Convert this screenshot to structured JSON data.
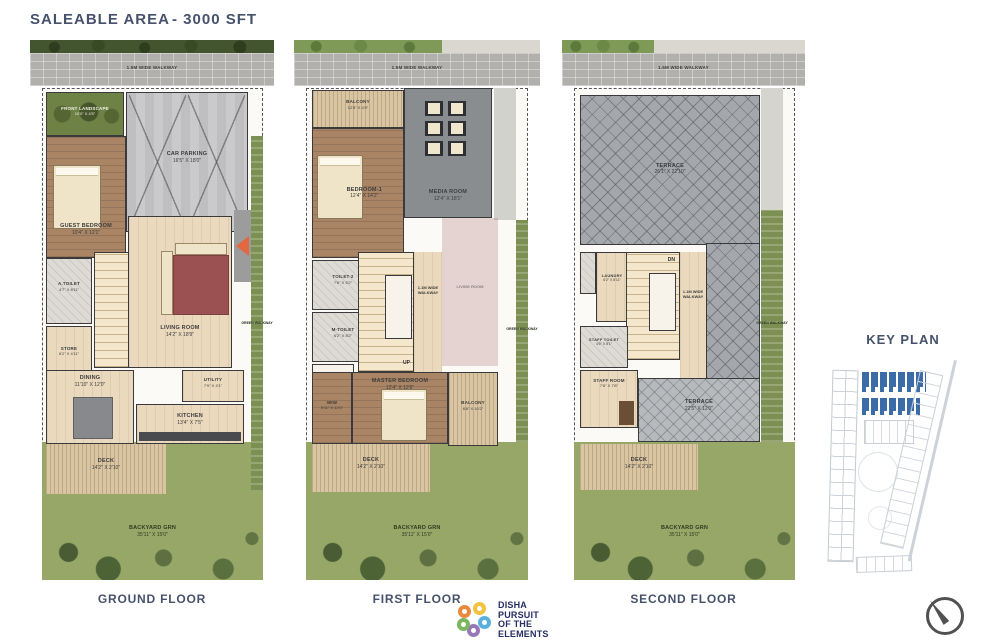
{
  "header": {
    "title": "SALEABLE AREA",
    "area": "- 3000 SFT"
  },
  "floors": [
    {
      "label": "GROUND FLOOR",
      "walkway_label": "1.5M WIDE WALKWAY",
      "rooms": {
        "front_landscape": {
          "name": "FRONT LANDSCAPE",
          "dims": "10'0\" X 4'5\""
        },
        "car_parking": {
          "name": "CAR PARKING",
          "dims": "16'5\" X 18'0\""
        },
        "guest_bedroom": {
          "name": "GUEST BEDROOM",
          "dims": "10'4\" X 12'1\""
        },
        "a_toilet": {
          "name": "A.TOILET",
          "dims": "4'7\" X 8'11\""
        },
        "store": {
          "name": "STORE",
          "dims": "6'2\" X 4'11\""
        },
        "living_room": {
          "name": "LIVING ROOM",
          "dims": "14'2\" X 18'9\""
        },
        "stairs": {
          "name": "UP"
        },
        "green_walkway": {
          "name": "GREEN WALKWAY"
        },
        "dining": {
          "name": "DINING",
          "dims": "11'10\" X 12'0\""
        },
        "utility": {
          "name": "UTILITY",
          "dims": "7'9\" X 4'1\""
        },
        "kitchen": {
          "name": "KITCHEN",
          "dims": "13'4\" X 7'5\""
        },
        "deck": {
          "name": "DECK",
          "dims": "14'2\" X 2'10\""
        },
        "backyard": {
          "name": "BACKYARD GRN",
          "dims": "35'11\" X 15'0\""
        }
      }
    },
    {
      "label": "FIRST FLOOR",
      "walkway_label": "1.5M WIDE WALKWAY",
      "rooms": {
        "balcony_front": {
          "name": "BALCONY",
          "dims": "12'8\" X 4'9\""
        },
        "bedroom_1": {
          "name": "BEDROOM-1",
          "dims": "12'4\" X 14'2\""
        },
        "media_room": {
          "name": "MEDIA ROOM",
          "dims": "12'4\" X 18'1\""
        },
        "toilet_2": {
          "name": "TOILET-2",
          "dims": "7'6\" X 5'2\""
        },
        "m_toilet": {
          "name": "M-TOILET",
          "dims": "6'2\" X 8'2\""
        },
        "walkway_corridor": {
          "name": "1.1M WIDE WALKWAY"
        },
        "stairs": {
          "name": "UP"
        },
        "living_void": {
          "name": "LIVING ROOM"
        },
        "wiw": {
          "name": "WIW",
          "dims": "5'11\" X 12'0\""
        },
        "master_bedroom": {
          "name": "MASTER BEDROOM",
          "dims": "12'4\" X 12'6\""
        },
        "balcony_rear": {
          "name": "BALCONY",
          "dims": "6'8\" X 10'2\""
        },
        "green_walkway": {
          "name": "GREEN WALKWAY"
        },
        "deck": {
          "name": "DECK",
          "dims": "14'2\" X 2'10\""
        },
        "backyard": {
          "name": "BACKYARD GRN",
          "dims": "35'11\" X 15'0\""
        }
      }
    },
    {
      "label": "SECOND FLOOR",
      "walkway_label": "1.5M WIDE WALKWAY",
      "rooms": {
        "terrace_upper": {
          "name": "TERRACE",
          "dims": "26'1\" X 22'10\""
        },
        "laundry": {
          "name": "LAUNDRY",
          "dims": "6'2\" X 8'11\""
        },
        "stairs": {
          "name": "DN"
        },
        "walkway_corridor": {
          "name": "1.1M WIDE WALKWAY"
        },
        "staff_toilet": {
          "name": "STAFF TOILET",
          "dims": "4'6\" X 8'1\""
        },
        "staff_room": {
          "name": "STAFF ROOM",
          "dims": "7'8\" X 7'8\""
        },
        "terrace_lower": {
          "name": "TERRACE",
          "dims": "22'5\" X 12'0\""
        },
        "green_walkway": {
          "name": "GREEN WALKWAY"
        },
        "deck": {
          "name": "DECK",
          "dims": "14'2\" X 2'10\""
        },
        "backyard": {
          "name": "BACKYARD GRN",
          "dims": "35'11\" X 15'0\""
        }
      }
    }
  ],
  "key_plan": {
    "title": "KEY PLAN"
  },
  "logo": {
    "brand": "DISHA",
    "tagline_line1": "PURSUIT",
    "tagline_line2": "OF THE",
    "tagline_line3": "ELEMENTS"
  },
  "colors": {
    "heading": "#46526B",
    "keyplan_highlight": "#3C6CA8",
    "logo_navy": "#272E62",
    "entry_arrow": "#E2683F"
  }
}
